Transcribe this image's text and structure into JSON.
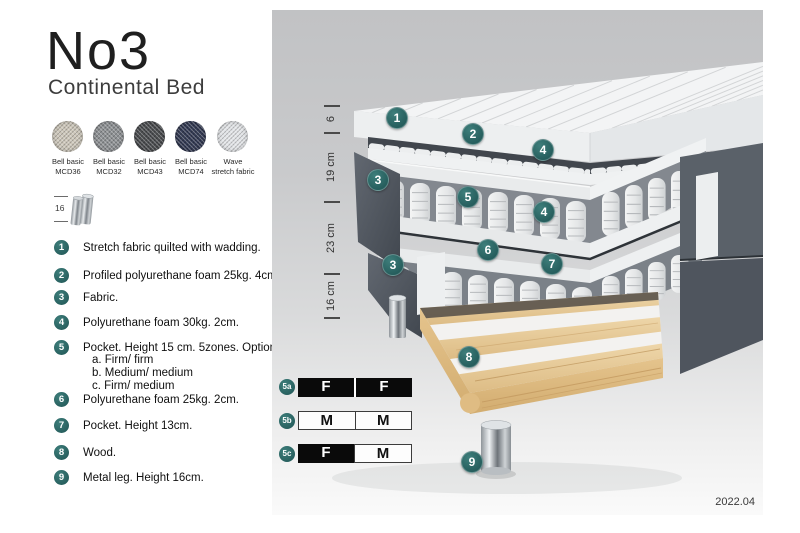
{
  "header": {
    "title": "No3",
    "subtitle": "Continental Bed"
  },
  "swatches": [
    {
      "name": "Bell basic",
      "code": "MCD36",
      "color": "#cdc7ba"
    },
    {
      "name": "Bell basic",
      "code": "MCD32",
      "color": "#8e9194"
    },
    {
      "name": "Bell basic",
      "code": "MCD43",
      "color": "#4a4c4f"
    },
    {
      "name": "Bell basic",
      "code": "MCD74",
      "color": "#333a53"
    },
    {
      "name": "Wave",
      "code": "stretch fabric",
      "color": "#e3e5e8"
    }
  ],
  "leg_spec": {
    "height": "16"
  },
  "spec_items": [
    {
      "num": "1",
      "text": "Stretch fabric quilted with wadding."
    },
    {
      "num": "2",
      "text": "Profiled polyurethane foam 25kg. 4cm."
    },
    {
      "num": "3",
      "text": "Fabric."
    },
    {
      "num": "4",
      "text": "Polyurethane foam 30kg. 2cm."
    },
    {
      "num": "5",
      "text": "Pocket. Height 15 cm. 5zones. Option:",
      "options": [
        "a. Firm/ firm",
        "b. Medium/ medium",
        "c. Firm/ medium"
      ]
    },
    {
      "num": "6",
      "text": "Polyurethane foam 25kg. 2cm."
    },
    {
      "num": "7",
      "text": "Pocket. Height 13cm."
    },
    {
      "num": "8",
      "text": "Wood."
    },
    {
      "num": "9",
      "text": "Metal leg. Height 16cm."
    }
  ],
  "dimension_labels": [
    "6",
    "19 cm",
    "23 cm",
    "16 cm"
  ],
  "diagram": {
    "callouts": [
      "1",
      "2",
      "3",
      "4",
      "5",
      "6",
      "7",
      "8",
      "9"
    ]
  },
  "firmness_options": [
    {
      "id": "5a",
      "cells": [
        {
          "label": "F",
          "style": "dark"
        },
        {
          "label": "F",
          "style": "dark"
        }
      ]
    },
    {
      "id": "5b",
      "cells": [
        {
          "label": "M",
          "style": "light"
        },
        {
          "label": "M",
          "style": "light"
        }
      ]
    },
    {
      "id": "5c",
      "cells": [
        {
          "label": "F",
          "style": "dark"
        },
        {
          "label": "M",
          "style": "light"
        }
      ]
    }
  ],
  "version": "2022.04",
  "colors": {
    "accent_teal": "#2e6b69",
    "dark_fabric": "#565c65",
    "wood": "#ddb980",
    "spring": "#e8eaec"
  }
}
